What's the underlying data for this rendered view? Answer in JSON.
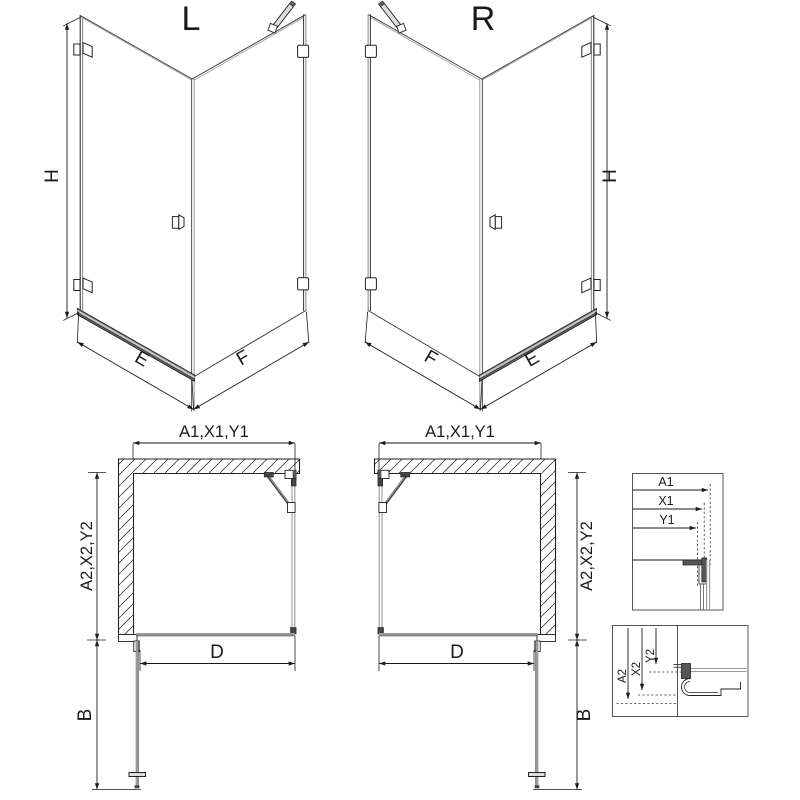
{
  "labels": {
    "variant_left": "L",
    "variant_right": "R",
    "height": "H",
    "door_width": "E",
    "side_width": "F",
    "plan_width": "A1,X1,Y1",
    "plan_depth": "A2,X2,Y2",
    "door_opening": "D",
    "door_swing": "B",
    "detail_top": {
      "a1": "A1",
      "x1": "X1",
      "y1": "Y1"
    },
    "detail_bottom": {
      "a2": "A2",
      "x2": "X2",
      "y2": "Y2"
    }
  },
  "colors": {
    "line": "#1a1a1a",
    "glass": "#9a9a9a",
    "threshold": "#888888",
    "background": "#ffffff"
  }
}
